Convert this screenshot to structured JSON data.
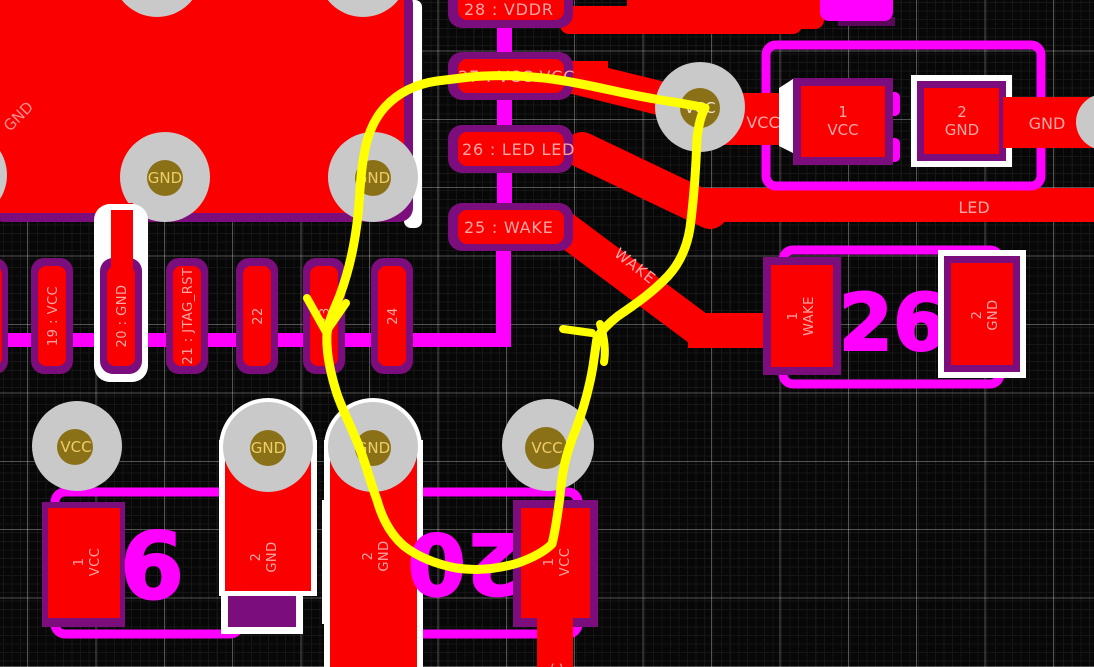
{
  "colors": {
    "copper_red": "#fa0000",
    "pad_border_purple": "#7c0d7c",
    "silk_magenta": "#ff00ff",
    "outline_white": "#ffffff",
    "via_gray": "#c9c9c9",
    "drill_gold": "#8a7117",
    "label_pink": "#ffa6a6",
    "gold_text": "#efce67",
    "route_yellow": "#ffff00",
    "background": "#070707"
  },
  "ground_plane": {
    "net_label": "GND",
    "via1_label": "GND",
    "via2_label": "GND"
  },
  "pin_header": {
    "pins": [
      "28 : VDDR",
      "27 : VCC VCC",
      "26 : LED LED",
      "25 : WAKE"
    ]
  },
  "pin_row": {
    "pins": [
      "19 : VCC",
      "20 : GND",
      "21 : JTAG_RST",
      "22",
      "23",
      "24"
    ]
  },
  "top_via": {
    "label": "VCC"
  },
  "trace_labels": {
    "vcc": "VCC",
    "gnd": "GND",
    "led": "LED",
    "wake": "WAKE",
    "bottom_vcc": "VCC"
  },
  "led_component": {
    "pad1": {
      "pin": "1",
      "net": "VCC"
    },
    "pad2": {
      "pin": "2",
      "net": "GND"
    }
  },
  "wake_component": {
    "designator": "26",
    "pad1": {
      "pin": "1",
      "net": "WAKE"
    },
    "pad2": {
      "pin": "2",
      "net": "GND"
    }
  },
  "bottom_vias": [
    "VCC",
    "GND",
    "GND",
    "VCC"
  ],
  "cap_left": {
    "designator": "6",
    "pad1": {
      "pin": "1",
      "net": "VCC"
    },
    "pad2": {
      "pin": "2",
      "net": "GND"
    }
  },
  "cap_right": {
    "designator": "20",
    "pad1": {
      "pin": "1",
      "net": "VCC"
    },
    "pad2": {
      "pin": "2",
      "net": "GND"
    }
  }
}
